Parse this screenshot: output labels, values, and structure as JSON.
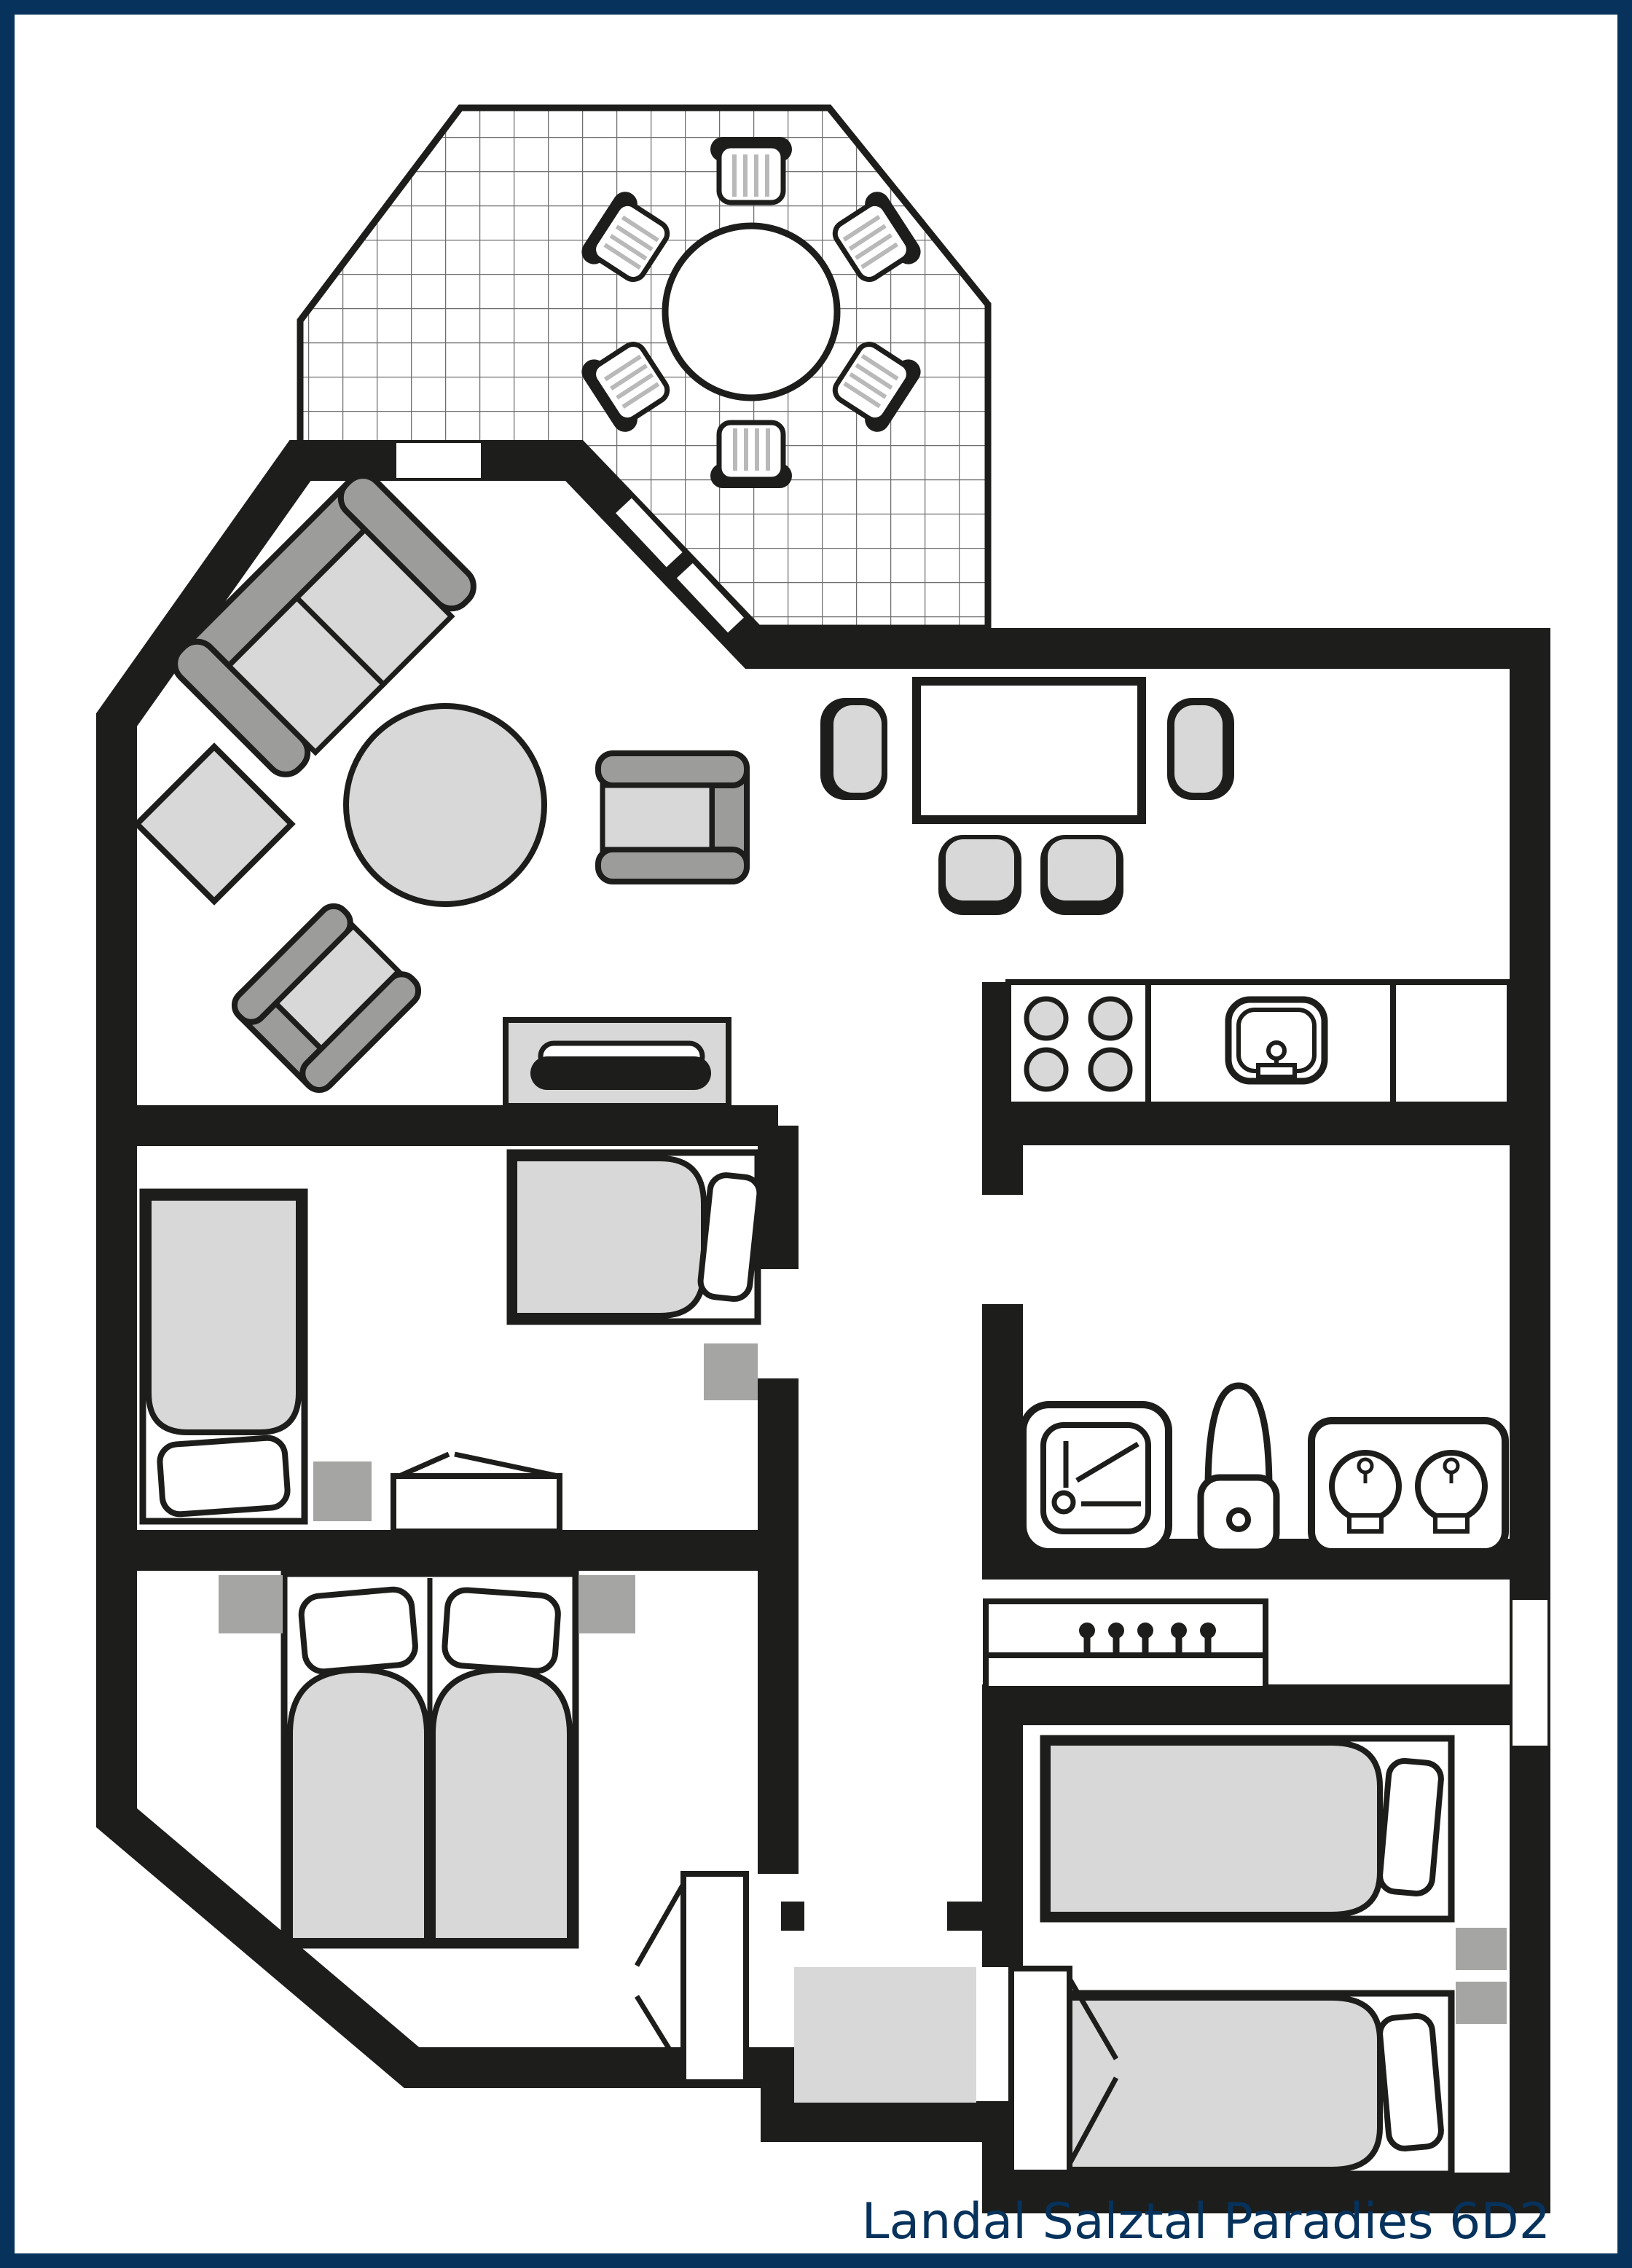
{
  "title": "Landal Salztal Paradies 6D2",
  "colors": {
    "frame_navy": "#06325c",
    "wall": "#1d1d1b",
    "furniture_light": "#d8d8d8",
    "furniture_mid": "#9c9c9b",
    "nightstand_gray": "#a5a5a4",
    "grid_line": "#6e6e6e",
    "floor": "#ffffff"
  },
  "floorplan": {
    "areas": [
      "terrace",
      "living-room",
      "dining-area",
      "kitchen",
      "bathroom",
      "hallway",
      "bedroom-1",
      "bedroom-2",
      "bedroom-3",
      "entry-vestibule"
    ],
    "furniture": [
      "terrace-round-table",
      "terrace-chairs-x6",
      "sofa",
      "side-table",
      "round-coffee-table",
      "armchair-x2",
      "tv-sideboard",
      "dining-table",
      "dining-chairs-x4",
      "hob-4-burners",
      "kitchen-sink",
      "shower",
      "toilet",
      "double-washbasin",
      "coat-rack-5-hooks",
      "single-bed-x2-bedroom-1",
      "wardrobe",
      "double-bed-bedroom-2",
      "nightstands",
      "single-bed-x2-bedroom-3",
      "doormat"
    ]
  }
}
